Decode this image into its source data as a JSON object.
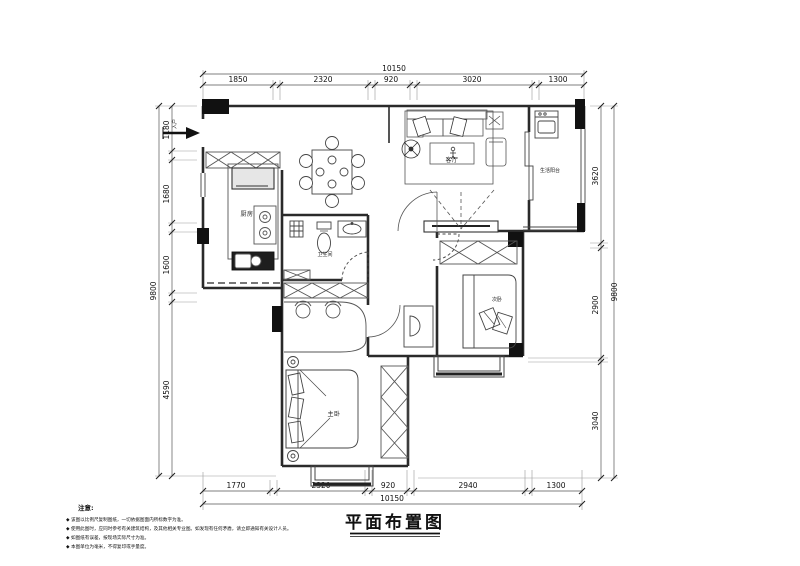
{
  "title": "平面布置图",
  "dims": {
    "top": {
      "total": "10150",
      "segments": [
        "1850",
        "2320",
        "920",
        "3020",
        "1300"
      ]
    },
    "bottom": {
      "total": "10150",
      "segments": [
        "1770",
        "2320",
        "920",
        "2940",
        "1300"
      ]
    },
    "left": {
      "total": "9800",
      "segments": [
        "1180",
        "1680",
        "1600",
        "4590"
      ]
    },
    "right": {
      "total": "9800",
      "segments": [
        "3620",
        "2900",
        "3040"
      ]
    }
  },
  "rooms": {
    "kitchen": "厨房",
    "bathroom": "卫生间",
    "living": "客厅",
    "balcony": "生活阳台",
    "master": "主卧",
    "second": "次卧",
    "entry": "入户"
  },
  "notes": {
    "heading": "注意:",
    "items": [
      "◆ 该图以比例尺复制图纸，一切依据图面内所标数字为准。",
      "◆ 使用此图时，应同时参考有关建筑结构，及其他相关专业图。如发现有任何矛盾，请立即通知有关设计人员。",
      "◆ 如图纸有误差，按现场实际尺寸为准。",
      "◆ 本图单位为毫米，不得复印或手量度。"
    ]
  },
  "colors": {
    "wall": "#2a2a2a",
    "furniture": "#555555",
    "column": "#111111",
    "dimline": "#666666"
  }
}
